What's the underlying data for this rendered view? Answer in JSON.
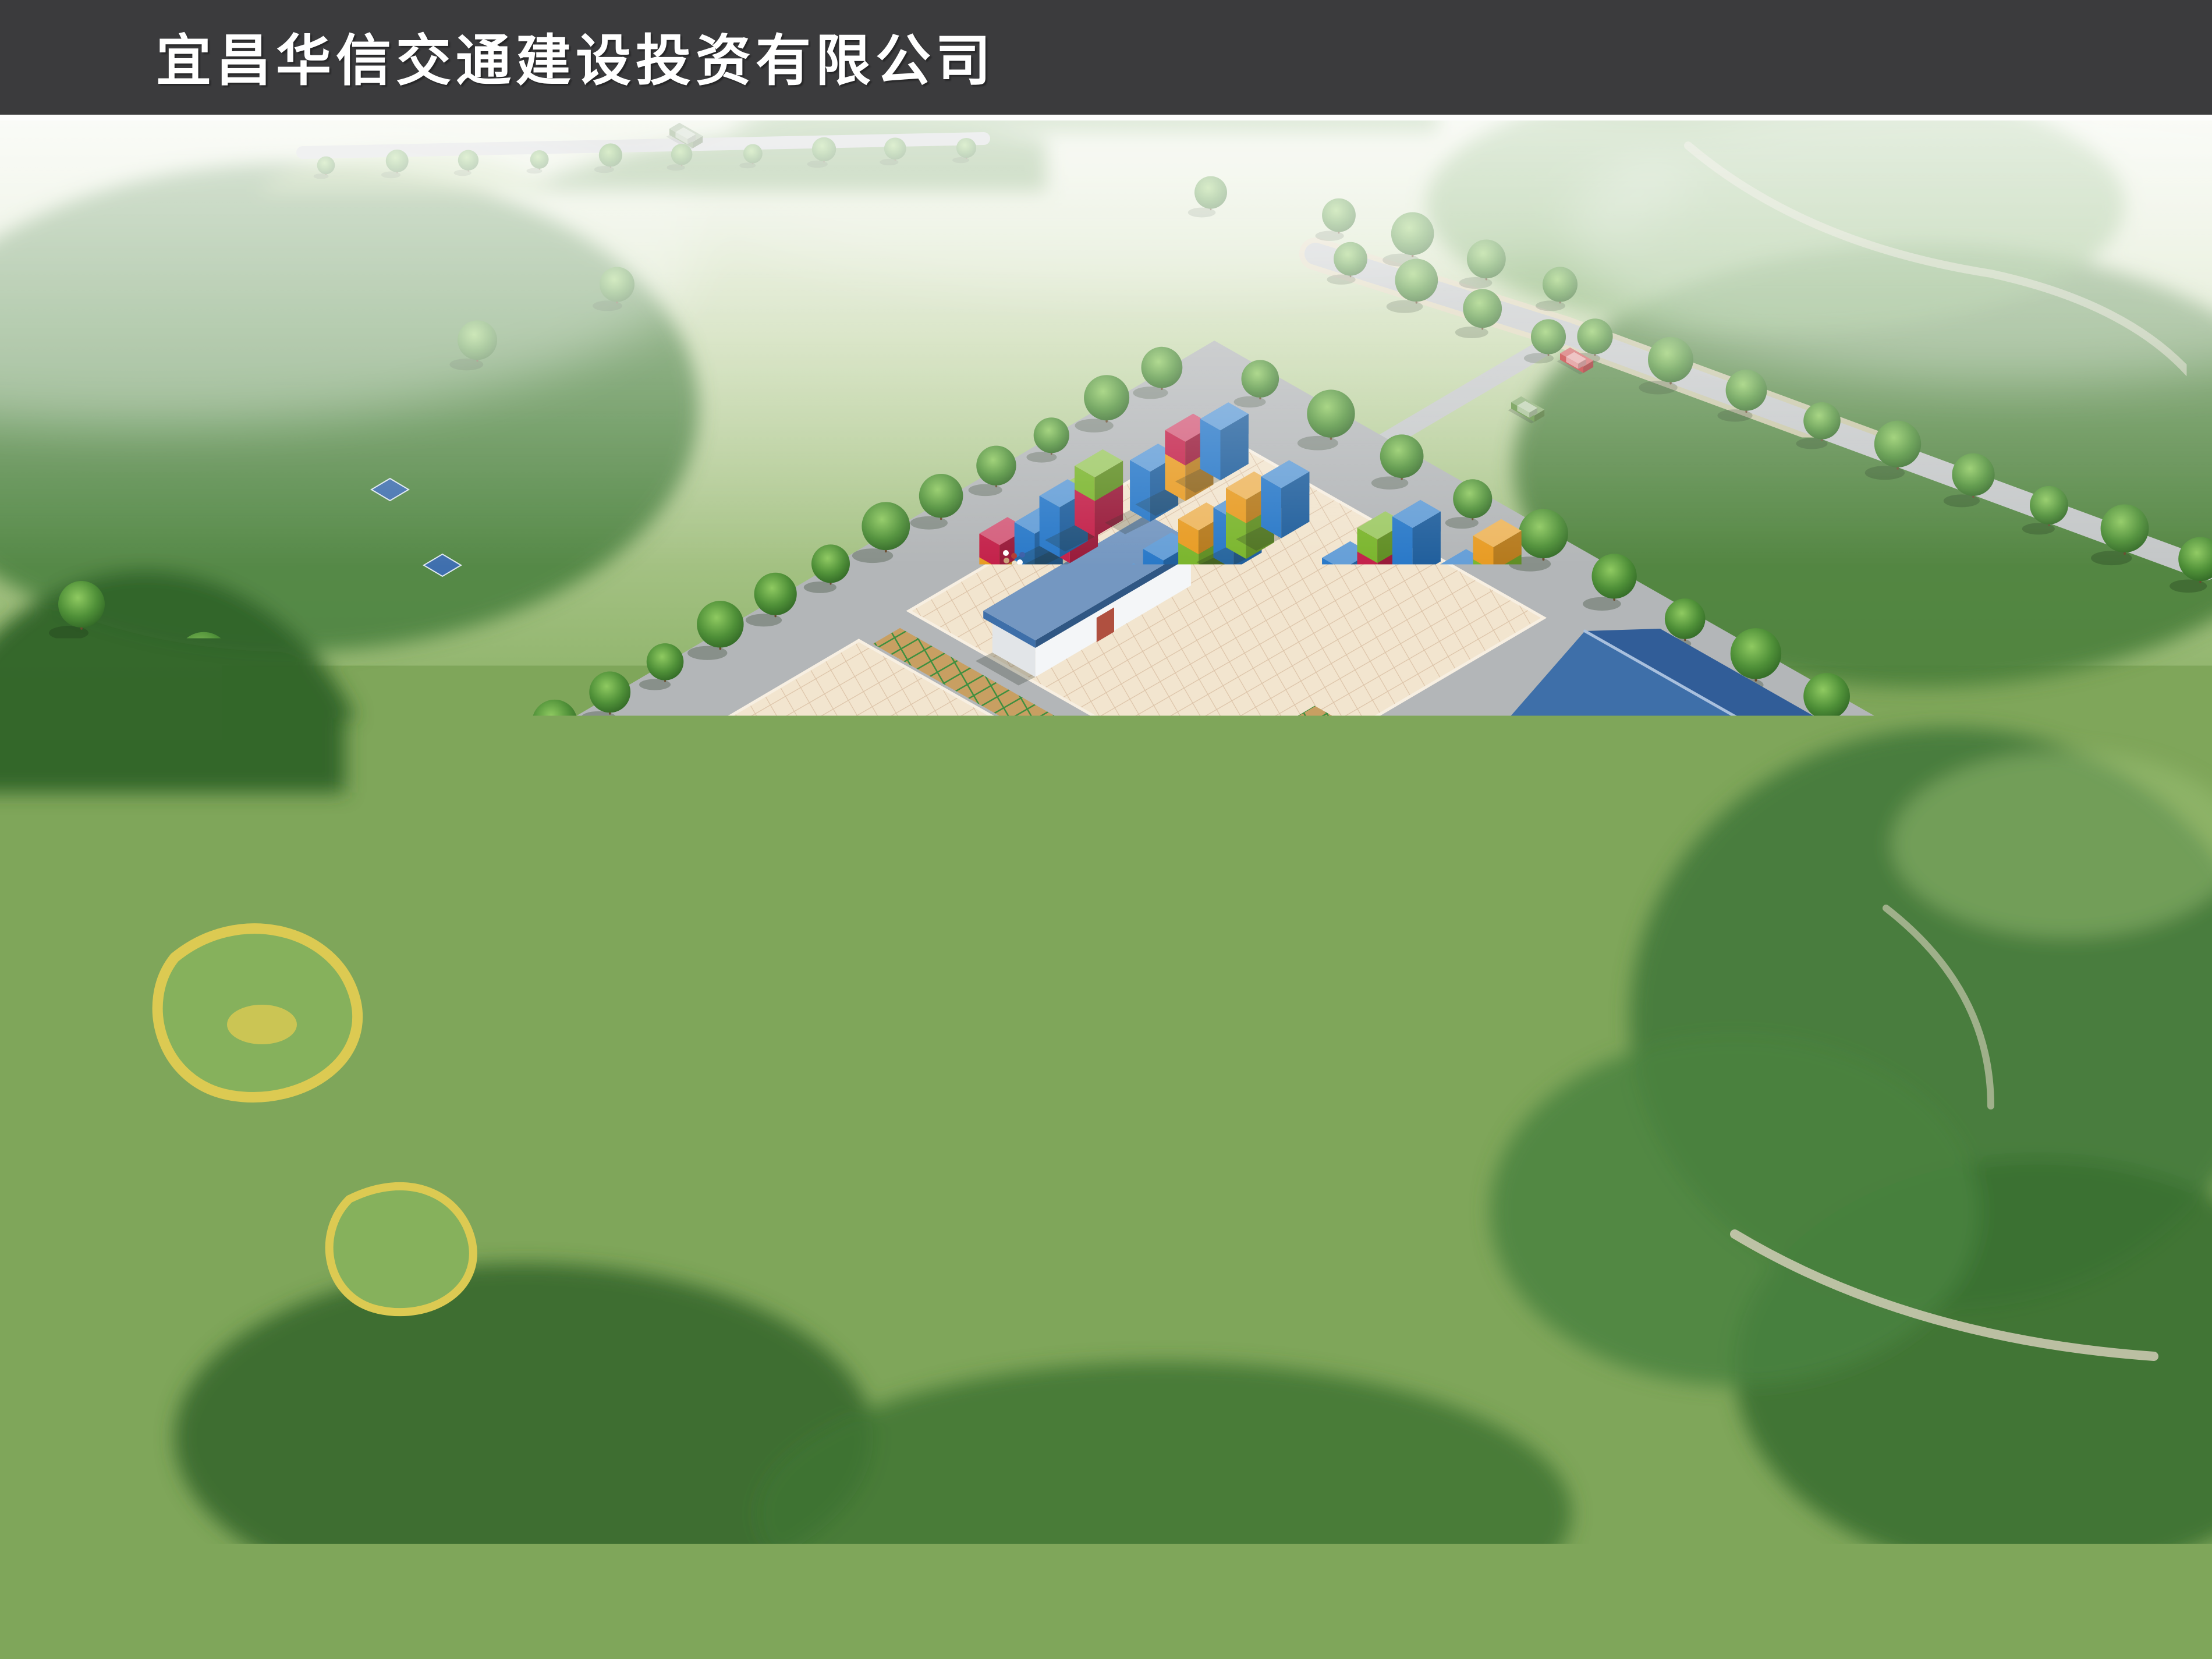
{
  "header": {
    "title": "宜昌华信交通建设投资有限公司"
  },
  "footer": {
    "caption": "宜昌市货运中心  鸟瞰图",
    "logo_icon": "red-globe-logo",
    "company_cn": "北京东方华太建筑设计工程有限责任公司武汉分公司",
    "company_en": "BEIJING DONGFANG HUATAI ARCHITECTURAL & ENGINEERING CO. LTD."
  },
  "palette": {
    "bar": "#3b3b3d",
    "separator": "#fdfdfd",
    "asphalt": "#b3b6b8",
    "avenue": "#bcbfc1",
    "paving": "#f2e5cf",
    "paving_line": "#dcc3a8",
    "paver_tan": "#c89f62",
    "paver_green": "#3f8f3f",
    "grass": "#79a351",
    "lawn": "#8fbc61",
    "tree_dark": "#2d5a26",
    "tree_mid": "#46853a",
    "roof_blue": "#3e6fa9",
    "roof_blue_dark": "#315d98",
    "wall_white": "#eef1f3",
    "door_red": "#b05040",
    "door_blue": "#3a6fc0",
    "container_blue": "#2878c8",
    "container_orange": "#e89b22",
    "container_red": "#c32049",
    "container_green": "#7ab52c",
    "truck_green": "#6d8a5a",
    "truck_pink": "#b8797a",
    "truck_white": "#e9e9e9",
    "car_blue": "#2f5fc0",
    "car_red": "#c02828",
    "car_green": "#5d8f3c",
    "logo_red": "#cf1a17"
  }
}
